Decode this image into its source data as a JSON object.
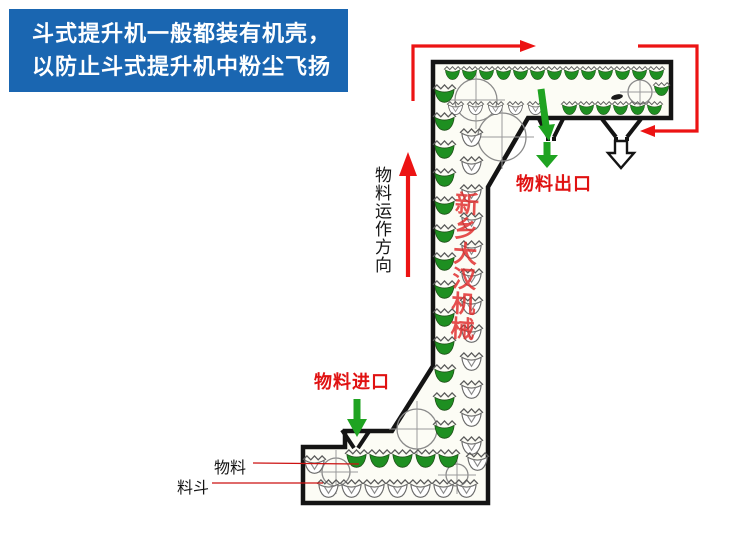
{
  "info_box": {
    "line1": "斗式提升机一般都装有机壳，",
    "line2": "以防止斗式提升机中粉尘飞扬"
  },
  "diagram": {
    "flow_direction_label": "物料运作方向",
    "outlet_label": "物料出口",
    "inlet_label": "物料进口",
    "material_label": "物料",
    "hopper_label": "料斗",
    "watermark": "新乡大汉机械"
  },
  "colors": {
    "info_box_bg": "#1a66b1",
    "info_box_text": "#ffffff",
    "arrow_red": "#ec1313",
    "label_red": "#e01212",
    "bucket_green": "#1e8f21",
    "arrow_green": "#1fa321",
    "housing_outline": "#141414",
    "watermark_red": "#e02a2a"
  }
}
